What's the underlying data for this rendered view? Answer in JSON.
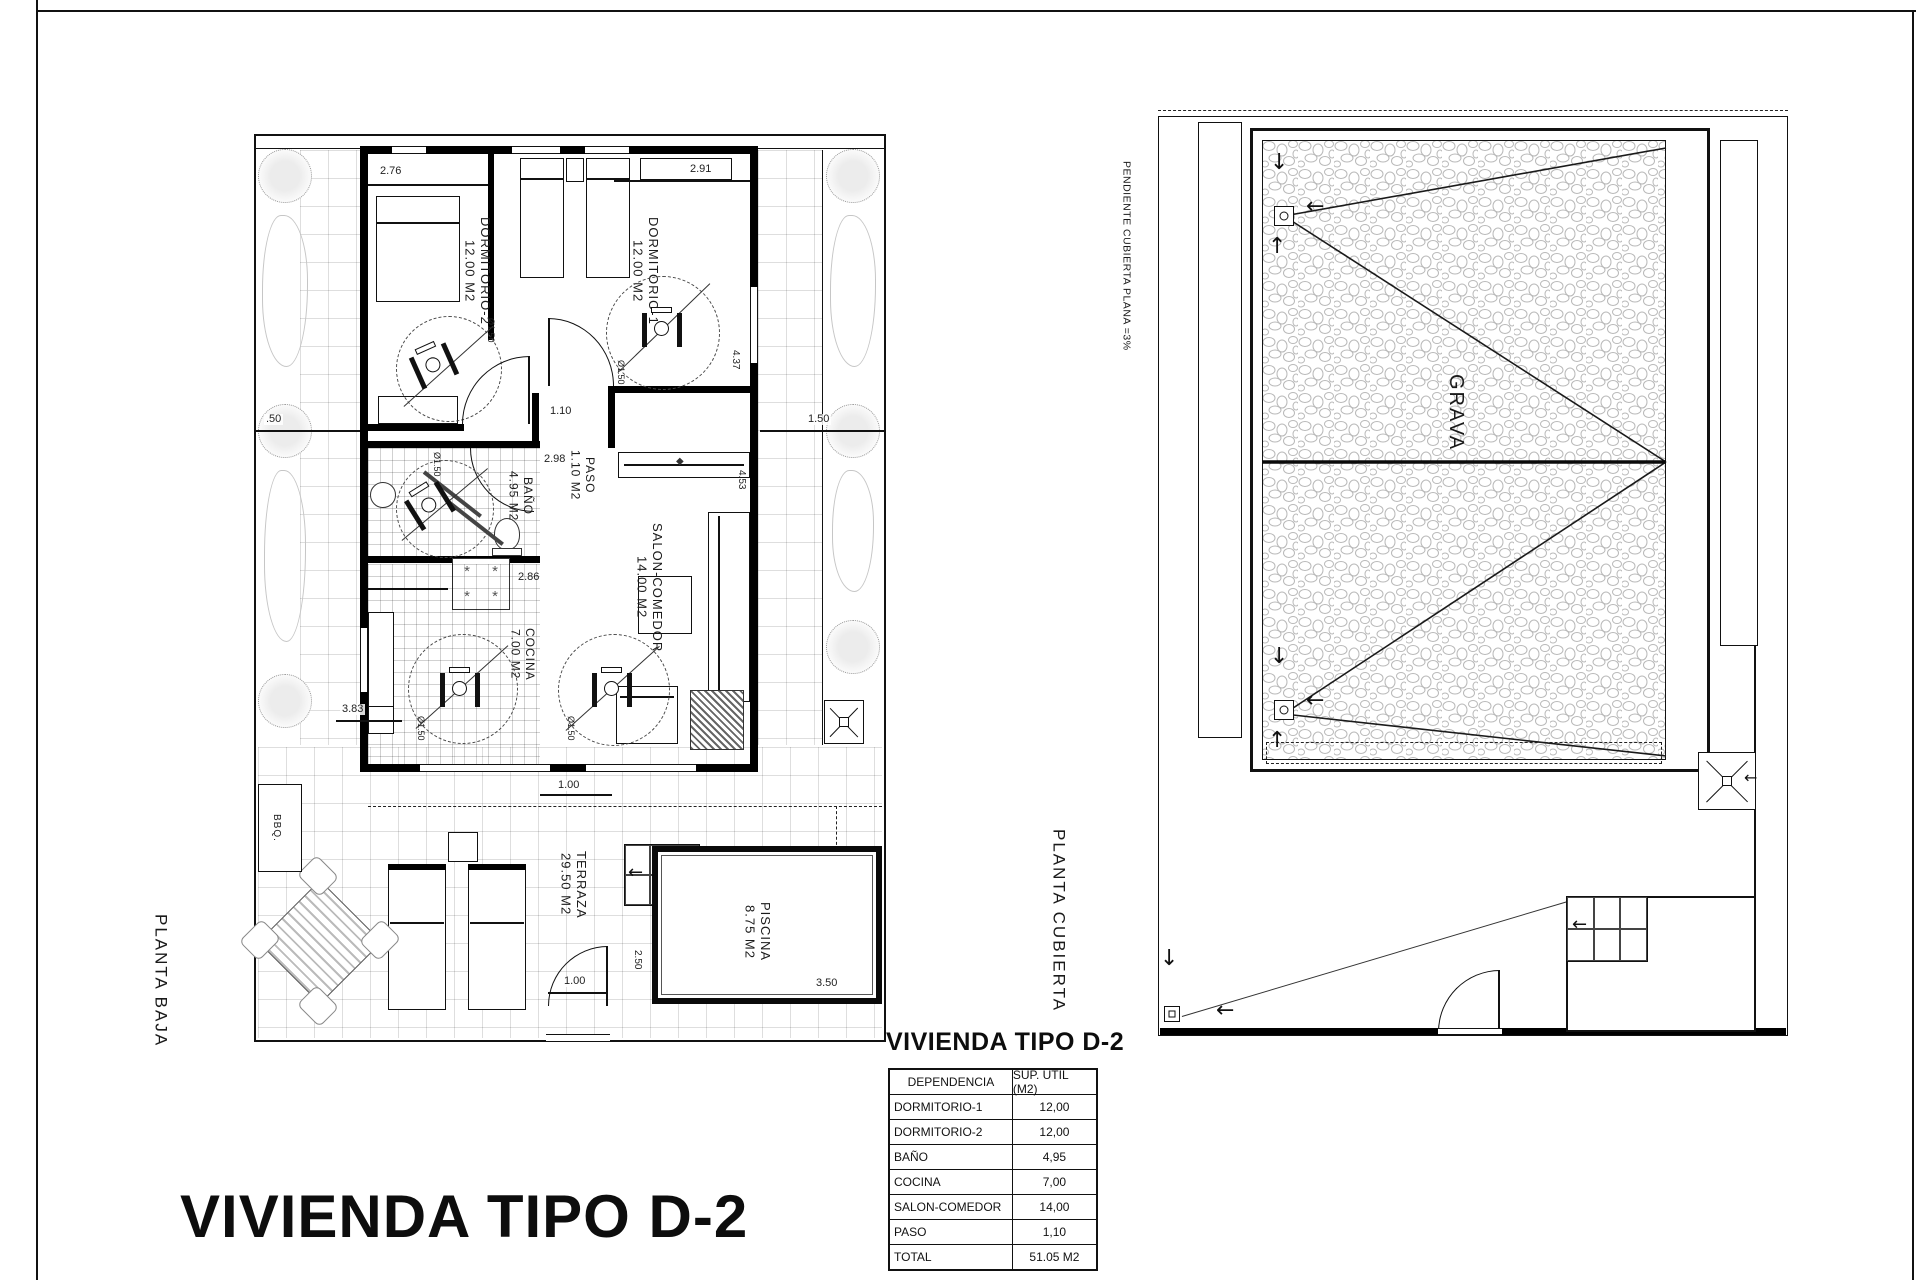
{
  "sheet": {
    "main_title": "VIVIENDA TIPO D-2"
  },
  "planta_baja": {
    "label": "PLANTA BAJA",
    "rooms": {
      "dormitorio2": {
        "name": "DORMITORIO-2",
        "area": "12.00 M2"
      },
      "dormitorio1": {
        "name": "DORMITORIO-1",
        "area": "12.00 M2"
      },
      "bano": {
        "name": "BAÑO",
        "area": "4.95 M2"
      },
      "paso": {
        "name": "PASO",
        "area": "1.10 M2"
      },
      "salon": {
        "name": "SALON-COMEDOR",
        "area": "14.00 M2"
      },
      "cocina": {
        "name": "COCINA",
        "area": "7.00 M2"
      },
      "terraza": {
        "name": "TERRAZA",
        "area": "29.50 M2"
      },
      "piscina": {
        "name": "PISCINA",
        "area": "8.75 M2"
      },
      "bbq": {
        "name": "BBQ."
      }
    },
    "dims": {
      "bed2_width": "2.76",
      "bed1_width": "2.91",
      "left_margin": ".50",
      "right_margin": "1.50",
      "bed1_depth": "4.37",
      "salon_depth": "4.53",
      "paso_width": "1.10",
      "hall_len": "2.98",
      "cocina_width": "2.86",
      "cocina_side": "3.83",
      "rear_opening": "1.00",
      "terrace_door": "1.00",
      "pool_side": "2.50",
      "pool_width": "3.50",
      "turning_circle": "Ø1.50"
    }
  },
  "planta_cubierta": {
    "label": "PLANTA CUBIERTA",
    "slope_note": "PENDIENTE CUBIERTA PLANA =3%",
    "surface": "GRAVA"
  },
  "area_table": {
    "title": "VIVIENDA TIPO D-2",
    "headers": [
      "DEPENDENCIA",
      "SUP. UTIL (M2)"
    ],
    "rows": [
      {
        "name": "DORMITORIO-1",
        "value": "12,00"
      },
      {
        "name": "DORMITORIO-2",
        "value": "12,00"
      },
      {
        "name": "BAÑO",
        "value": "4,95"
      },
      {
        "name": "COCINA",
        "value": "7,00"
      },
      {
        "name": "SALON-COMEDOR",
        "value": "14,00"
      },
      {
        "name": "PASO",
        "value": "1,10"
      },
      {
        "name": "TOTAL",
        "value": "51.05 M2"
      }
    ]
  }
}
